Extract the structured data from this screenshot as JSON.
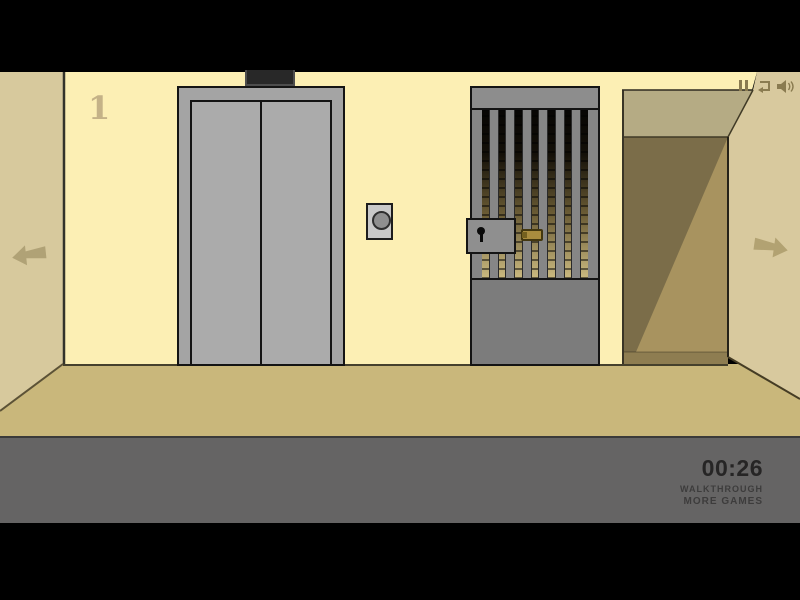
{
  "room": {
    "floor_number": "1",
    "description": "escape-game hallway with elevator, locked barred gate and corridor"
  },
  "hud": {
    "timer": "00:26",
    "walkthrough_label": "WALKTHROUGH",
    "more_games_label": "MORE GAMES"
  },
  "controls": {
    "icons": [
      "pause-icon",
      "restart-icon",
      "sound-icon"
    ],
    "nav": [
      "nav-left-arrow",
      "nav-right-arrow"
    ]
  },
  "colors": {
    "wall_cream": "#fcefb4",
    "side_wall_tan": "#d7c99d",
    "floor_tan": "#c9b77b",
    "foreground_band_gray": "#656464",
    "letterbox_black": "#000000",
    "elevator_gray": "#ababab",
    "gate_gray": "#868686",
    "brass_latch": "#a98c3e",
    "corridor_dark": "#7b6d49",
    "arrow_tan": "#b0a276",
    "hud_text": "#262525"
  }
}
